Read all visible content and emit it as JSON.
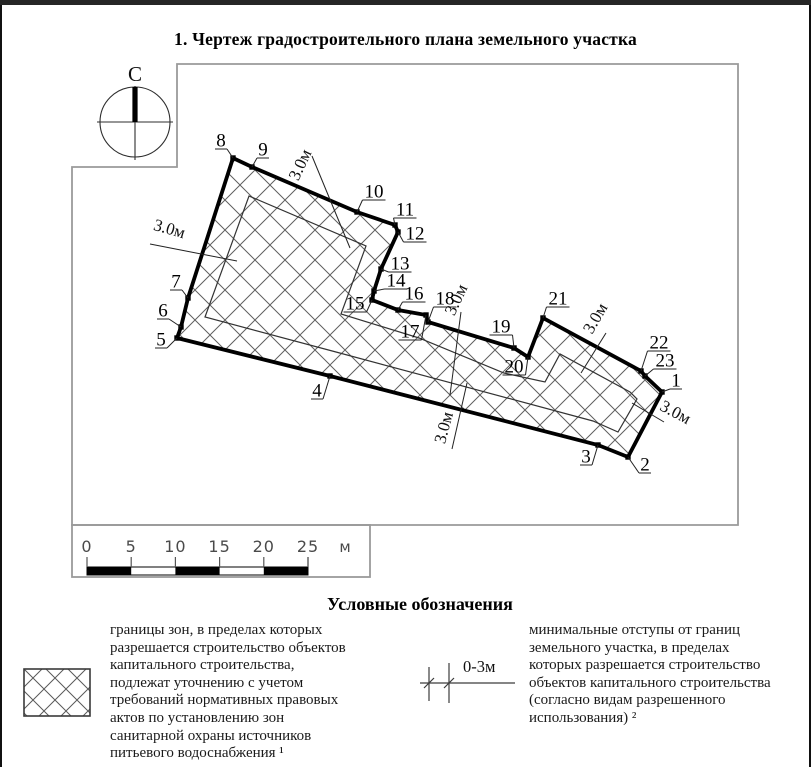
{
  "page": {
    "title": "1. Чертеж градостроительного плана земельного участка"
  },
  "compass": {
    "label": "С"
  },
  "figure": {
    "outer": [
      [
        662,
        387
      ],
      [
        628,
        452
      ],
      [
        598,
        440
      ],
      [
        330,
        371
      ],
      [
        177,
        333
      ],
      [
        181,
        322
      ],
      [
        188,
        293
      ],
      [
        233,
        153
      ],
      [
        252,
        162
      ],
      [
        357,
        207
      ],
      [
        395,
        220
      ],
      [
        398,
        227
      ],
      [
        381,
        264
      ],
      [
        374,
        286
      ],
      [
        372,
        295
      ],
      [
        398,
        305
      ],
      [
        426,
        310
      ],
      [
        428,
        317
      ],
      [
        514,
        343
      ],
      [
        528,
        352
      ],
      [
        543,
        313
      ],
      [
        641,
        366
      ],
      [
        645,
        371
      ]
    ],
    "inner": [
      [
        205,
        312
      ],
      [
        249,
        191
      ],
      [
        366,
        241
      ],
      [
        341,
        309
      ],
      [
        419,
        333
      ],
      [
        504,
        368
      ],
      [
        545,
        377
      ],
      [
        560,
        349
      ],
      [
        630,
        387
      ],
      [
        637,
        394
      ],
      [
        618,
        427
      ],
      [
        593,
        416
      ],
      [
        336,
        347
      ]
    ],
    "vertex_labels": [
      {
        "n": "1",
        "x": 676,
        "y": 375
      },
      {
        "n": "2",
        "x": 645,
        "y": 459
      },
      {
        "n": "3",
        "x": 586,
        "y": 451
      },
      {
        "n": "4",
        "x": 317,
        "y": 385
      },
      {
        "n": "5",
        "x": 161,
        "y": 334
      },
      {
        "n": "6",
        "x": 163,
        "y": 305
      },
      {
        "n": "7",
        "x": 176,
        "y": 276
      },
      {
        "n": "8",
        "x": 221,
        "y": 135
      },
      {
        "n": "9",
        "x": 263,
        "y": 144
      },
      {
        "n": "10",
        "x": 374,
        "y": 186
      },
      {
        "n": "11",
        "x": 405,
        "y": 204
      },
      {
        "n": "12",
        "x": 415,
        "y": 228
      },
      {
        "n": "13",
        "x": 400,
        "y": 258
      },
      {
        "n": "14",
        "x": 396,
        "y": 275
      },
      {
        "n": "15",
        "x": 355,
        "y": 298
      },
      {
        "n": "16",
        "x": 414,
        "y": 288
      },
      {
        "n": "17",
        "x": 410,
        "y": 326
      },
      {
        "n": "18",
        "x": 445,
        "y": 293
      },
      {
        "n": "19",
        "x": 501,
        "y": 321
      },
      {
        "n": "20",
        "x": 514,
        "y": 361
      },
      {
        "n": "21",
        "x": 558,
        "y": 293
      },
      {
        "n": "22",
        "x": 659,
        "y": 337
      },
      {
        "n": "23",
        "x": 665,
        "y": 355
      }
    ],
    "setback_labels": [
      {
        "text": "3.0м",
        "x": 168,
        "y": 229,
        "rot": 16,
        "leader": [
          150,
          239,
          237,
          256
        ]
      },
      {
        "text": "3.0м",
        "x": 305,
        "y": 162,
        "rot": -65,
        "leader": [
          312,
          151,
          350,
          243
        ]
      },
      {
        "text": "3.0м",
        "x": 461,
        "y": 297,
        "rot": -65,
        "leader": [
          461,
          307,
          450,
          390
        ]
      },
      {
        "text": "3.0м",
        "x": 449,
        "y": 424,
        "rot": -75,
        "leader": [
          467,
          378,
          452,
          444
        ]
      },
      {
        "text": "3.0м",
        "x": 600,
        "y": 316,
        "rot": -60,
        "leader": [
          606,
          328,
          581,
          368
        ]
      },
      {
        "text": "3.0м",
        "x": 673,
        "y": 412,
        "rot": 28,
        "leader": [
          664,
          417,
          632,
          398
        ]
      }
    ]
  },
  "scalebar": {
    "ticks": [
      "0",
      "5",
      "10",
      "15",
      "20",
      "25"
    ],
    "unit": "м"
  },
  "legend": {
    "heading": "Условные обозначения",
    "items": [
      {
        "symbol": "crosshatch-swatch",
        "text": "границы зон, в пределах которых\nразрешается строительство объектов\nкапитального строительства,\nподлежат уточнению с учетом\nтребований нормативных правовых\nактов по установлению зон\nсанитарной охраны источников\nпитьевого водоснабжения ¹"
      },
      {
        "symbol": "setback-dimension",
        "dim_label": "0-3м",
        "text": "минимальные отступы от границ\nземельного участка, в пределах\nкоторых разрешается строительство\nобъектов капитального строительства\n(согласно видам разрешенного\nиспользования) ²"
      }
    ]
  }
}
